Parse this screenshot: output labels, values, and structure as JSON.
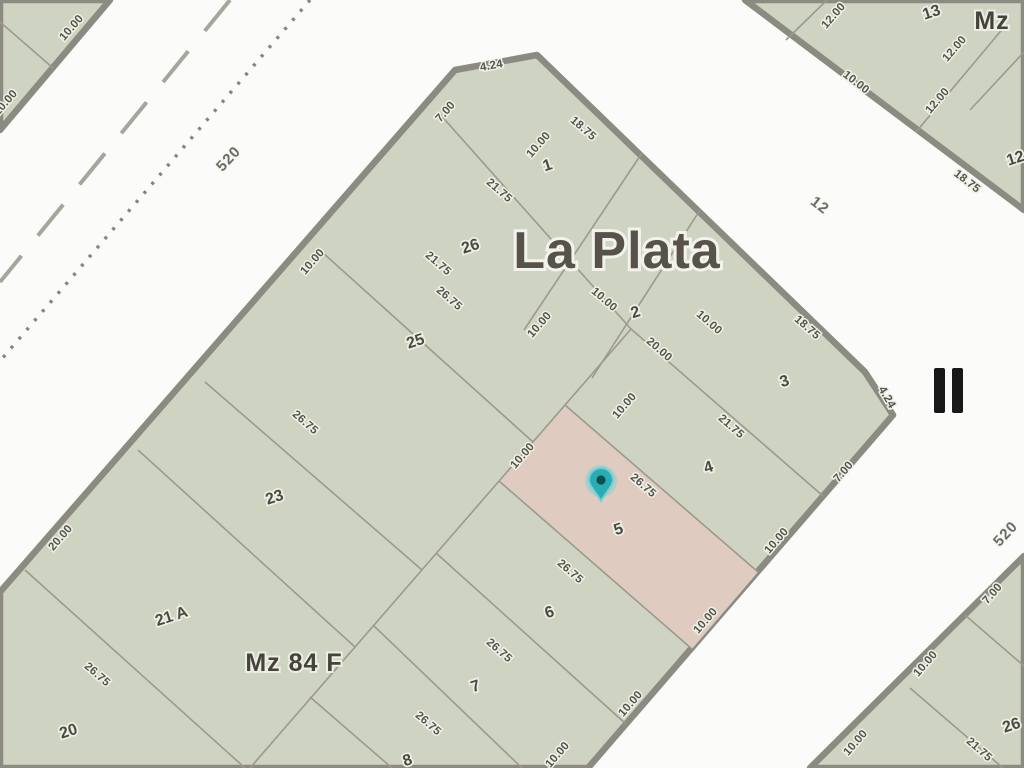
{
  "titles": {
    "city": "La Plata",
    "block": "Mz 84 F",
    "adjacent_block": "Mz",
    "zone_marker": "II"
  },
  "streets": {
    "street_520_upper": "520",
    "street_12": "12",
    "street_520_lower": "520"
  },
  "colors": {
    "street_bg": "#fbfbf9",
    "block_fill": "#cfd3c2",
    "block_border": "#8b8b81",
    "highlight_parcel_fill": "#dfcbc0",
    "pin_fill": "#2aacb5",
    "pin_ring": "#6fd0d6",
    "pin_center": "#0b4f55"
  },
  "parcels": {
    "p1": "1",
    "p2": "2",
    "p3": "3",
    "p4": "4",
    "p5": "5",
    "p6": "6",
    "p7": "7",
    "p8": "8",
    "p20": "20",
    "p21a": "21 A",
    "p23": "23",
    "p25": "25",
    "p26": "26",
    "p13": "13",
    "p12tr": "12",
    "p26br": "26"
  },
  "dimensions": {
    "nw_700": "7.00",
    "nw_1000": "10.00",
    "nw_2000": "20.00",
    "cham_n": "4.24",
    "cham_e": "4.24",
    "ne_1875_1": "18.75",
    "ne_1875_3": "18.75",
    "se_700": "7.00",
    "se_1000_4": "10.00",
    "se_1000_5": "10.00",
    "se_1000_6": "10.00",
    "se_1000_7": "10.00",
    "p1_2175": "21.75",
    "p1_1000": "10.00",
    "b1_2175": "21.75",
    "b1_2675": "26.75",
    "b2_2675": "26.75",
    "b4_2675": "26.75",
    "f34_2175": "21.75",
    "f45_2675": "26.75",
    "f56_2675": "26.75",
    "f67_2675": "26.75",
    "f78_2675": "26.75",
    "c2_1000a": "10.00",
    "c2_2000": "20.00",
    "c2_1000b": "10.00",
    "c2_1000c": "10.00",
    "sp_1000a": "10.00",
    "sp_1000b": "10.00",
    "tl_1000a": "10.00",
    "tl_1000b": "10.00",
    "tr_1200a": "12.00",
    "tr_1200b": "12.00",
    "tr_1200c": "12.00",
    "tr_1000": "10.00",
    "tr_1875": "18.75",
    "br_700": "7.00",
    "br_1000a": "10.00",
    "br_1000b": "10.00",
    "br_2175": "21.75"
  }
}
